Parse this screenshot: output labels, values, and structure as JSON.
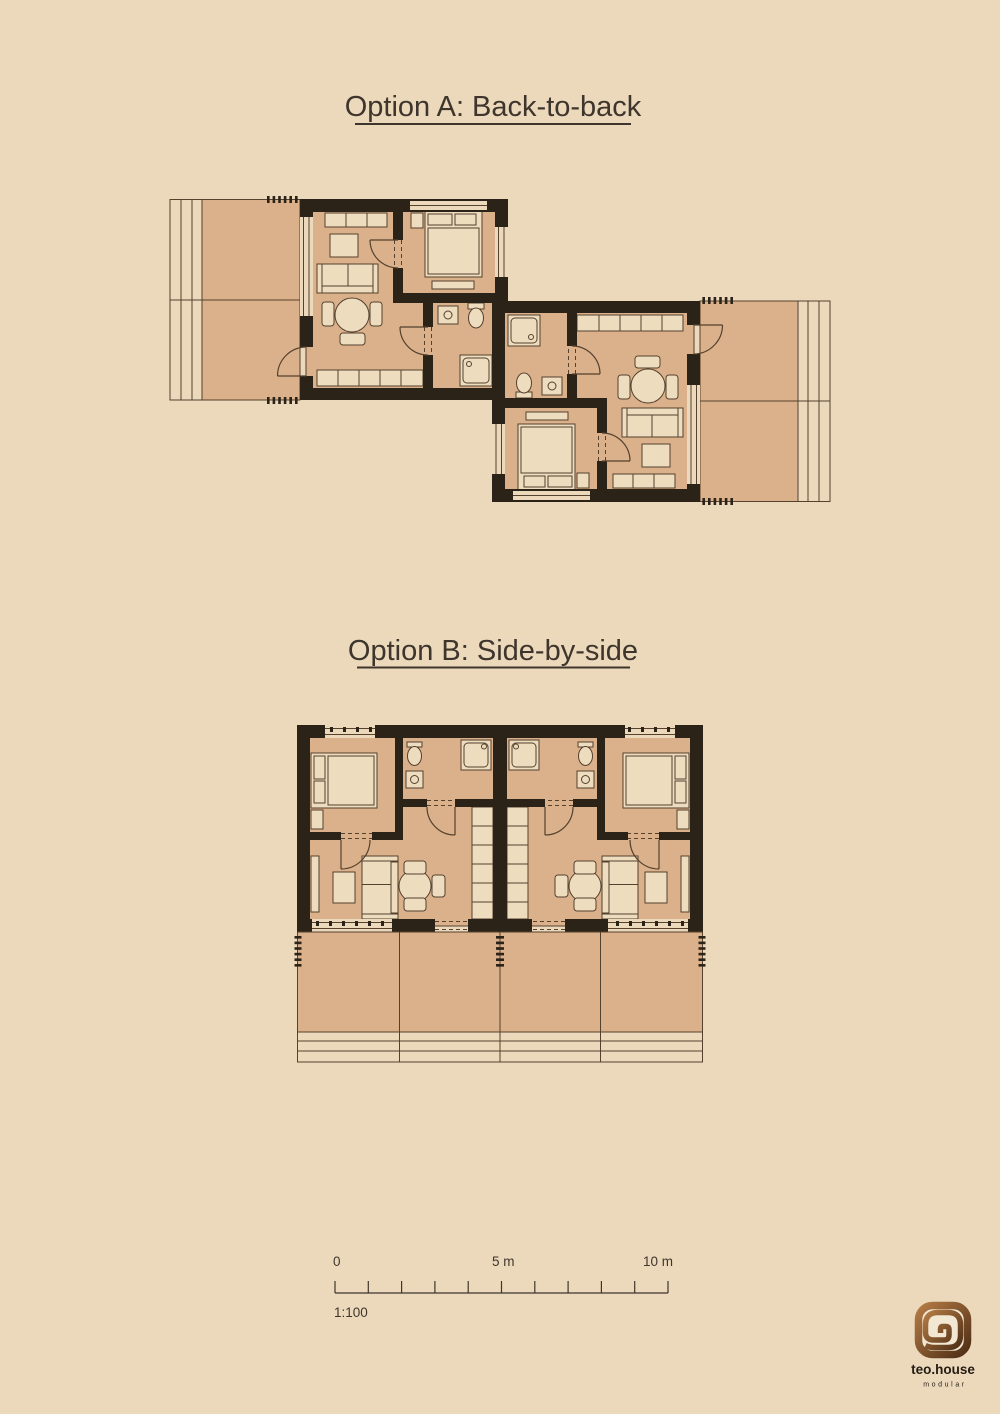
{
  "poster": {
    "titles": {
      "option_a": "Option A: Back-to-back",
      "option_b": "Option B: Side-by-side"
    },
    "scale_bar": {
      "start_label": "0",
      "mid_label": "5 m",
      "end_label": "10 m",
      "ratio_label": "1:100",
      "tick_count": 11
    },
    "logo": {
      "name": "teo.house",
      "tagline": "modular",
      "icon": "square-spiral-logo-icon"
    },
    "plans": {
      "option_a": {
        "layout": "back-to-back",
        "units": 2,
        "rooms_per_unit": [
          "living room",
          "bedroom",
          "bathroom",
          "terrace"
        ]
      },
      "option_b": {
        "layout": "side-by-side",
        "units": 2,
        "rooms_per_unit": [
          "living room",
          "bedroom",
          "bathroom",
          "terrace"
        ]
      }
    },
    "colors": {
      "background": "#ecd9bc",
      "floor": "#dbb18b",
      "furniture": "#eedcbf",
      "wall": "#2b2218",
      "line": "#54412e",
      "text": "#3e352c",
      "logo_grad_start": "#b37a45",
      "logo_grad_end": "#4f2f15",
      "logo_bg": "#f2e7d2",
      "logo_text": "#241c14"
    }
  }
}
